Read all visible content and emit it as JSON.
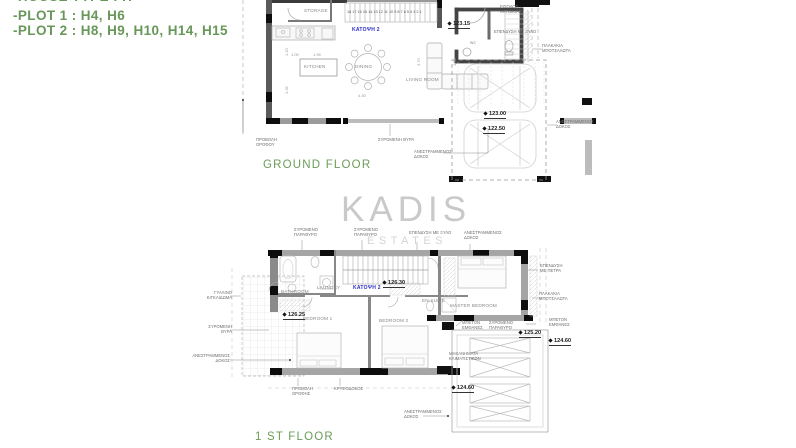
{
  "header_notes": {
    "lines": [
      "-HOUSE TYPE : H",
      "-PLOT 1 : H4, H6",
      "-PLOT 2 : H8, H9, H10, H14, H15"
    ],
    "color": "#68975a"
  },
  "watermark": {
    "line1": "KADIS",
    "line2": "ESTATES"
  },
  "ground_floor": {
    "title": "GROUND FLOOR",
    "labels": [
      {
        "name": "gf-storage-label",
        "cls": "room",
        "x": 304,
        "y": 8,
        "text": "STORAGE"
      },
      {
        "name": "gf-kitchen-label",
        "cls": "room",
        "x": 304,
        "y": 64,
        "text": "KITCHEN"
      },
      {
        "name": "gf-dining-label",
        "cls": "room",
        "x": 355,
        "y": 64,
        "text": "DINING"
      },
      {
        "name": "gf-living-room-label",
        "cls": "room",
        "x": 406,
        "y": 77,
        "text": "LIVING ROOM"
      },
      {
        "name": "gf-wc-label",
        "cls": "room",
        "x": 470,
        "y": 40,
        "text": "wc"
      },
      {
        "name": "gf-stair-numbers",
        "cls": "stairnums",
        "x": 347,
        "y": 10,
        "text": "18 17 16 15 14 13 12 11 10 9 8 7 6 5 4 3 2 1"
      },
      {
        "name": "gf-plan-id",
        "cls": "planid",
        "x": 352,
        "y": 27,
        "text": "ΚΑΤΟΨΗ 2"
      },
      {
        "name": "gf-level-123-15",
        "cls": "level",
        "x": 448,
        "y": 21,
        "text": "123.15"
      },
      {
        "name": "gf-level-123-00",
        "cls": "level",
        "x": 484,
        "y": 111,
        "text": "123.00"
      },
      {
        "name": "gf-level-122-50",
        "cls": "level",
        "x": 483,
        "y": 126,
        "text": "122.50"
      },
      {
        "name": "gf-annot-roof-projection",
        "cls": "annot",
        "x": 256,
        "y": 137,
        "text": "ΠΡΟΒΟΛΗ\nΟΡΟΦΟΥ"
      },
      {
        "name": "gf-annot-sliding-door",
        "cls": "annot",
        "x": 378,
        "y": 137,
        "text": "ΣΥΡΟΜΕΝΗ ΘΥΡΑ"
      },
      {
        "name": "gf-annot-inverted-beam-bottom",
        "cls": "annot",
        "x": 414,
        "y": 149,
        "text": "ΑΝΕΣΤΡΑΜΜΕΝΟΣ\nΔΟΚΟΣ"
      },
      {
        "name": "gf-annot-inverted-beam-right",
        "cls": "annot",
        "x": 556,
        "y": 119,
        "text": "ΑΝΕΣΤΡΑΜΜΕΝΟΣ\nΔΟΚΟΣ"
      },
      {
        "name": "gf-annot-entrance",
        "cls": "annot",
        "x": 500,
        "y": 4,
        "text": "ΕΙΣΟΔΟΣ\nΚΑΤΟΙΚΙΑΣ"
      },
      {
        "name": "gf-annot-wood-cladding",
        "cls": "annot",
        "x": 494,
        "y": 29,
        "text": "ΕΠΕΝΔΥΣΗ ΜΕ ΞΥΛΟ"
      },
      {
        "name": "gf-annot-pebble-tiles",
        "cls": "annot",
        "x": 542,
        "y": 43,
        "text": "ΠΛΑΚΑΚΙΑ\nΜΠΟΤΣΑΛΩΤΑ"
      },
      {
        "name": "gf-dim-1",
        "cls": "dim",
        "x": 291,
        "y": 52,
        "text": "1.00"
      },
      {
        "name": "gf-dim-2",
        "cls": "dim",
        "x": 313,
        "y": 52,
        "text": "1.95"
      },
      {
        "name": "gf-dim-3",
        "cls": "dim",
        "x": 358,
        "y": 93,
        "text": "4.30"
      },
      {
        "name": "gf-dim-4",
        "cls": "dim vert",
        "x": 416,
        "y": 66,
        "text": "3.70"
      },
      {
        "name": "gf-dim-5",
        "cls": "dim vert",
        "x": 284,
        "y": 56,
        "text": "1.20"
      },
      {
        "name": "gf-dim-6",
        "cls": "dim vert",
        "x": 284,
        "y": 94,
        "text": "1.35"
      },
      {
        "name": "gf-dim-7",
        "cls": "dim vert",
        "x": 452,
        "y": 66,
        "text": "1.70"
      },
      {
        "name": "ground-floor-title",
        "cls": "floor-title",
        "x": 263,
        "y": 158,
        "text": "GROUND FLOOR"
      }
    ]
  },
  "first_floor": {
    "title": "1 ST FLOOR",
    "labels": [
      {
        "name": "ff-bathroom-label",
        "cls": "room",
        "x": 281,
        "y": 289,
        "text": "BATHROOM"
      },
      {
        "name": "ff-laundry-label",
        "cls": "room",
        "x": 317,
        "y": 285,
        "text": "LAUNDRY"
      },
      {
        "name": "ff-bedroom1-label",
        "cls": "room",
        "x": 303,
        "y": 316,
        "text": "BEDROOM 1"
      },
      {
        "name": "ff-bedroom2-label",
        "cls": "room",
        "x": 379,
        "y": 318,
        "text": "BEDROOM 2"
      },
      {
        "name": "ff-master-bedroom-label",
        "cls": "room",
        "x": 450,
        "y": 303,
        "text": "MASTER BEDROOM"
      },
      {
        "name": "ff-ensuite-label",
        "cls": "room",
        "x": 422,
        "y": 298,
        "text": "EN-SUITE"
      },
      {
        "name": "ff-plan-id",
        "cls": "planid",
        "x": 353,
        "y": 285,
        "text": "ΚΑΤΟΨΗ 2"
      },
      {
        "name": "ff-level-126-30",
        "cls": "level",
        "x": 383,
        "y": 280,
        "text": "126.30"
      },
      {
        "name": "ff-level-126-25",
        "cls": "level",
        "x": 283,
        "y": 312,
        "text": "126.25"
      },
      {
        "name": "ff-level-125-20",
        "cls": "level",
        "x": 519,
        "y": 330,
        "text": "125.20"
      },
      {
        "name": "ff-level-124-60-right",
        "cls": "level",
        "x": 549,
        "y": 338,
        "text": "124.60"
      },
      {
        "name": "ff-level-124-60-left",
        "cls": "level",
        "x": 452,
        "y": 385,
        "text": "124.60"
      },
      {
        "name": "ff-annot-sliding-window-1",
        "cls": "annot",
        "x": 294,
        "y": 227,
        "text": "ΣΥΡΟΜΕΝΟ\nΠΑΡΑΘΥΡΟ"
      },
      {
        "name": "ff-annot-sliding-window-2",
        "cls": "annot",
        "x": 354,
        "y": 227,
        "text": "ΣΥΡΟΜΕΝΟ\nΠΑΡΑΘΥΡΟ"
      },
      {
        "name": "ff-annot-wood-cladding",
        "cls": "annot",
        "x": 409,
        "y": 230,
        "text": "ΕΠΕΝΔΥΣΗ ΜΕ ΞΥΛΟ"
      },
      {
        "name": "ff-annot-inverted-beam-top",
        "cls": "annot",
        "x": 464,
        "y": 230,
        "text": "ΑΝΕΣΤΡΑΜΜΕΝΟΣ\nΔΟΚΟΣ"
      },
      {
        "name": "ff-annot-stone-cladding",
        "cls": "annot",
        "x": 540,
        "y": 263,
        "text": "ΕΠΕΝΔΥΣΗ\nΜΕ ΠΕΤΡΑ"
      },
      {
        "name": "ff-annot-pebble-tiles",
        "cls": "annot",
        "x": 539,
        "y": 291,
        "text": "ΠΛΑΚΑΚΙΑ\nΜΠΟΤΣΑΛΩΤΑ"
      },
      {
        "name": "ff-annot-exposed-concrete-1",
        "cls": "annot",
        "x": 462,
        "y": 320,
        "text": "ΜΠΕΤΟΝ\nΕΜΦΑΝΕΣ"
      },
      {
        "name": "ff-annot-sliding-window-3",
        "cls": "annot",
        "x": 489,
        "y": 320,
        "text": "ΣΥΡΟΜΕΝΟ\nΠΑΡΑΘΥΡΟ"
      },
      {
        "name": "ff-annot-exposed-concrete-2",
        "cls": "annot",
        "x": 549,
        "y": 317,
        "text": "ΜΠΕΤΟΝ\nΕΜΦΑΝΕΣ"
      },
      {
        "name": "ff-annot-ac-units",
        "cls": "annot",
        "x": 449,
        "y": 351,
        "text": "ΜΗΧΑΝΗΜΑΤΑ\nΚΛΙΜΑΤΙΣΤΙΚΩΝ"
      },
      {
        "name": "ff-annot-glass-railing",
        "cls": "annot rt",
        "x": 186,
        "y": 290,
        "text": "ΓΥΑΛΙΝΟ\nΚΙΓΚΛΙΔΩΜΑ"
      },
      {
        "name": "ff-annot-sliding-door",
        "cls": "annot rt",
        "x": 186,
        "y": 324,
        "text": "ΣΥΡΟΜΕΝΗ\nΘΥΡΑ"
      },
      {
        "name": "ff-annot-inverted-beam-left",
        "cls": "annot rt",
        "x": 184,
        "y": 353,
        "text": "ΑΝΕΣΤΡΑΜΜΕΝΟΣ\nΔΟΚΟΣ"
      },
      {
        "name": "ff-annot-roof-projection",
        "cls": "annot",
        "x": 292,
        "y": 386,
        "text": "ΠΡΟΒΟΛΗ\nΟΡΟΦΗΣ"
      },
      {
        "name": "ff-annot-hidden-beam",
        "cls": "annot",
        "x": 334,
        "y": 386,
        "text": "ΚΡΥΦΟΔΟΚΟΣ"
      },
      {
        "name": "ff-annot-inverted-beam-bottom",
        "cls": "annot",
        "x": 404,
        "y": 409,
        "text": "ΑΝΕΣΤΡΑΜΜΕΝΟΣ\nΔΟΚΟΣ"
      },
      {
        "name": "first-floor-title",
        "cls": "floor-title",
        "x": 255,
        "y": 430,
        "text": "1 ST FLOOR"
      }
    ]
  }
}
